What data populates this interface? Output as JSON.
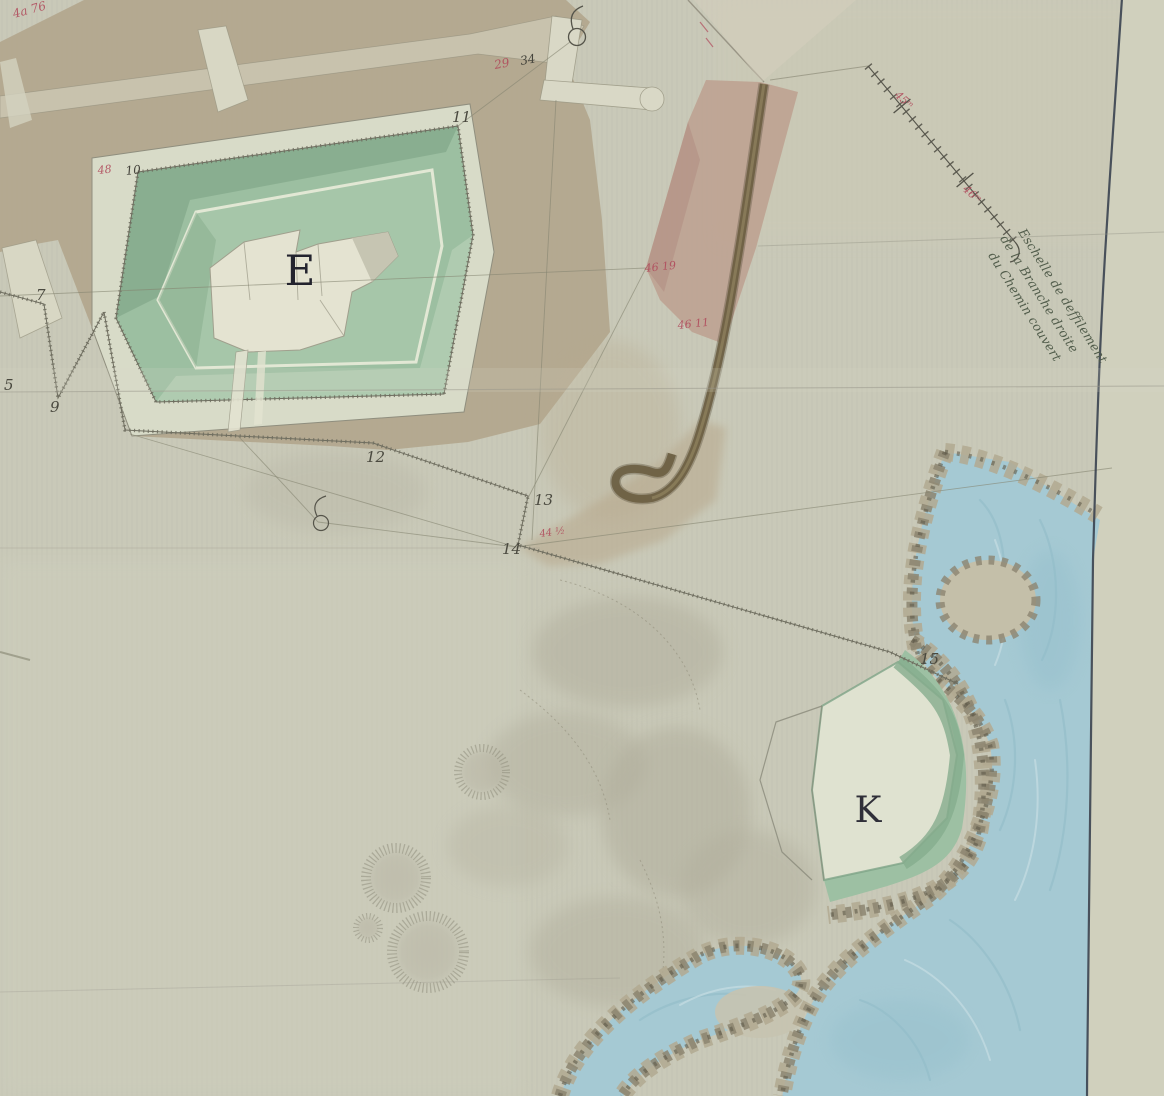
{
  "map": {
    "description": "Manuscript fortification plan, pen and watercolour",
    "plan_labels": {
      "fort": "E",
      "redoubt": "K"
    },
    "survey_point_labels": {
      "p5": "5",
      "p7": "7",
      "p9": "9",
      "p11": "11",
      "p12": "12",
      "p13": "13",
      "p14": "14",
      "p15": "15"
    },
    "red_measurements": {
      "top_left": "4a 76",
      "fort_corner": "48",
      "road_top": "29",
      "wedge_upper": "46 19",
      "wedge_lower": "46 11",
      "point14": "44 ½",
      "chain_upper": "45ᵐ",
      "chain_lower": "46ᵐ"
    },
    "ink_measurements": {
      "fort_corner": "10",
      "road_top": "34"
    },
    "scale_note": {
      "line1": "Eschelle de deffilement",
      "line2": "de la Branche droite",
      "line3": "du Chemin couvert"
    },
    "colors": {
      "paper": "#c9c9b8",
      "esplanade_khaki": "#b2a68d",
      "glacis_green": "#9cbfa1",
      "water_blue": "#a5c9d3",
      "terrain_pink": "#bda08f",
      "road_brown": "#6b5e41",
      "red_ink": "#b04b5c",
      "dark_ink": "#45443c",
      "border_line": "#3a4250"
    }
  }
}
